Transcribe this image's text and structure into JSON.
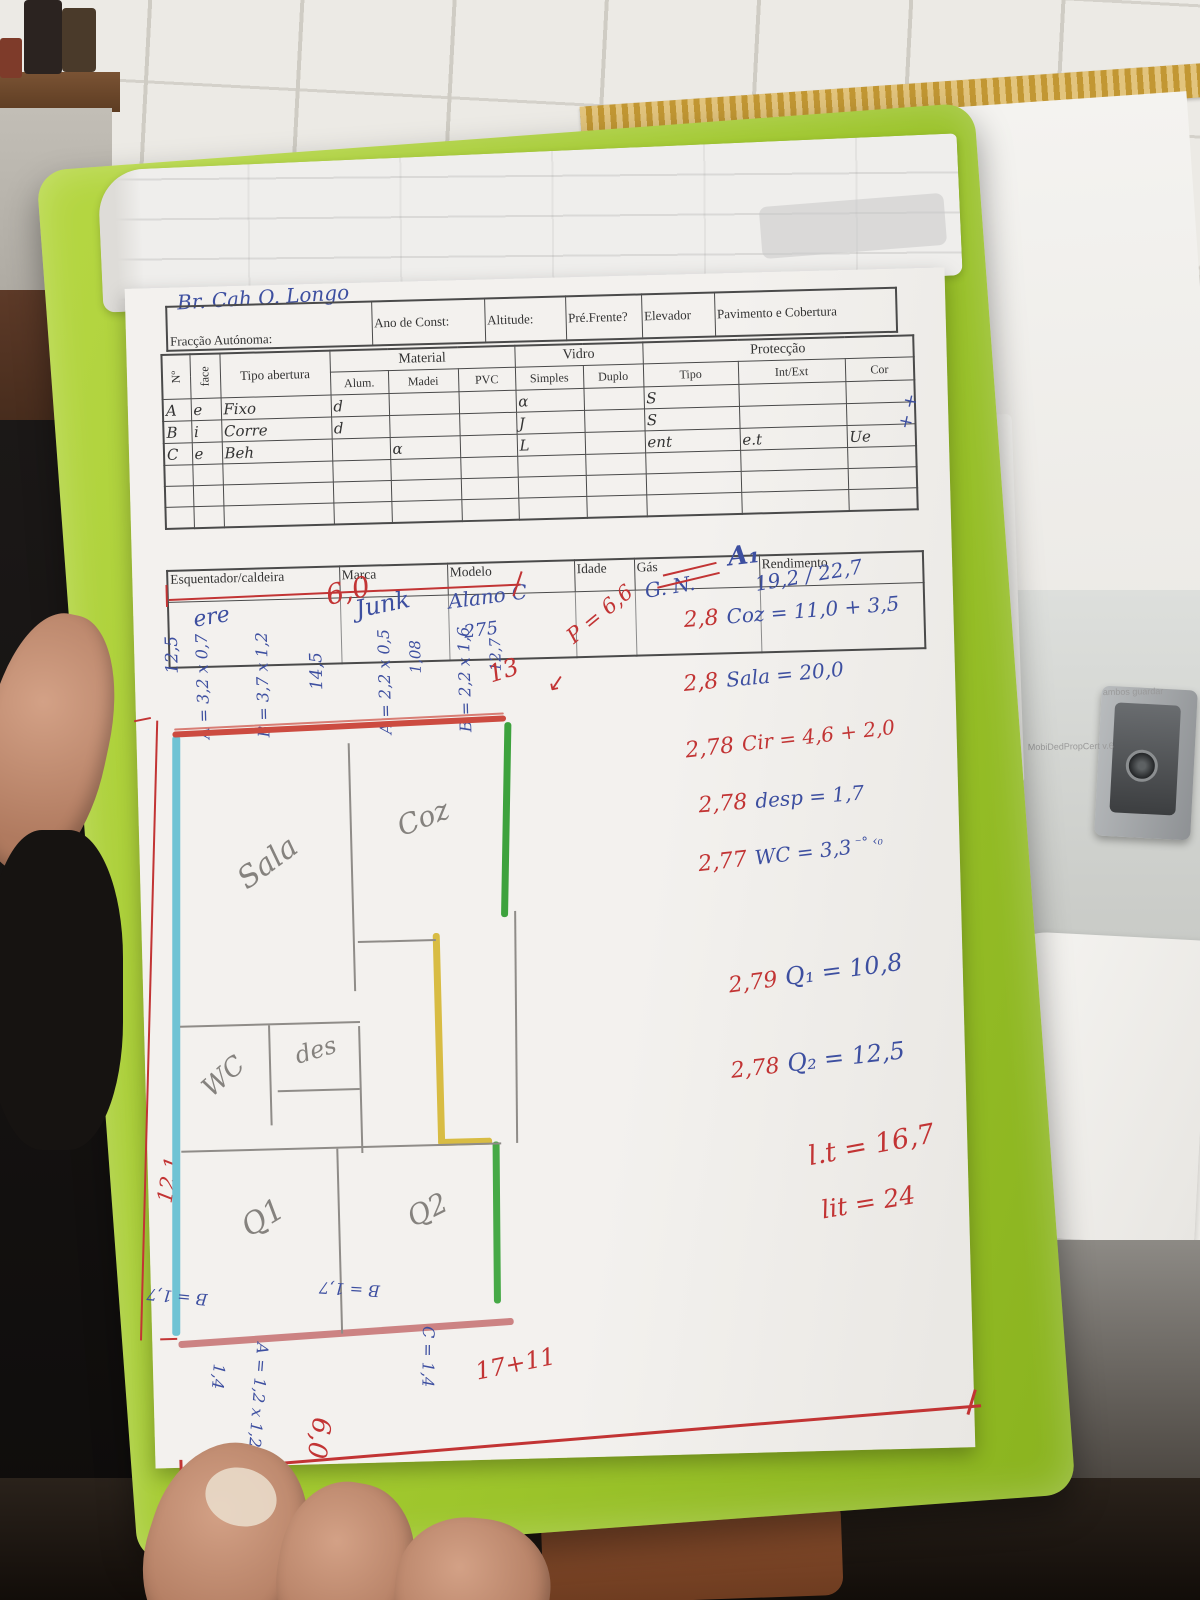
{
  "photo": {
    "background_texts": {
      "paper_note_1": "ambos guardar",
      "paper_note_2": "MobiDedPropCert v.6"
    }
  },
  "form": {
    "title_scribble": "Br. Cah O. Longo",
    "header": {
      "fraccao": "Fracção Autónoma:",
      "ano": "Ano de Const:",
      "altitude": "Altitude:",
      "pre_frente": "Pré.Frente?",
      "elevador": "Elevador",
      "pavimento": "Pavimento e Cobertura"
    },
    "table": {
      "groups": {
        "material": "Material",
        "vidro": "Vidro",
        "proteccao": "Protecção"
      },
      "cols": {
        "no": "Nº",
        "face": "face",
        "tipo_abertura": "Tipo abertura",
        "alum": "Alum.",
        "madei": "Madei",
        "pvc": "PVC",
        "simples": "Simples",
        "duplo": "Duplo",
        "tipo": "Tipo",
        "int_ext": "Int/Ext",
        "cor": "Cor"
      },
      "rows": [
        {
          "no": "A",
          "face": "e",
          "tipo": "Fixo",
          "alum": "d",
          "madei": "",
          "pvc": "",
          "simples": "α",
          "duplo": "",
          "prot": "S",
          "intext": "",
          "cor": ""
        },
        {
          "no": "B",
          "face": "i",
          "tipo": "Corre",
          "alum": "d",
          "madei": "",
          "pvc": "",
          "simples": "J",
          "duplo": "",
          "prot": "S",
          "intext": "",
          "cor": ""
        },
        {
          "no": "C",
          "face": "e",
          "tipo": "Beh",
          "alum": "",
          "madei": "α",
          "pvc": "",
          "simples": "L",
          "duplo": "",
          "prot": "ent",
          "intext": "e.t",
          "cor": "Ue"
        }
      ],
      "margin_marks": "+ +"
    },
    "heater": {
      "label": "Esquentador/caldeira",
      "marca": "Marca",
      "modelo": "Modelo",
      "idade": "Idade",
      "gas": "Gás",
      "rendimento": "Rendimento",
      "values": {
        "esq": "ere",
        "marca": "Junk",
        "modelo": "Alano C",
        "modelo2": "275",
        "gas": "G. N.",
        "rendimento": "19,2 / 22,7"
      }
    }
  },
  "calcs": {
    "a1": "A₁",
    "lines": [
      {
        "h": "2,8",
        "body": "Coz = 11,0 + 3,5"
      },
      {
        "h": "2,8",
        "body": "Sala = 20,0"
      },
      {
        "h": "2,78",
        "body": "Cir = 4,6 + 2,0"
      },
      {
        "h": "2,78",
        "body": "desp = 1,7"
      },
      {
        "h": "2,77",
        "body": "WC = 3,3",
        "marks": "⁻° ‹₀"
      },
      {
        "h": "2,79",
        "body": "Q₁ = 10,8"
      },
      {
        "h": "2,78",
        "body": "Q₂ = 12,5"
      }
    ],
    "totals": [
      "l.t = 16,7",
      "lit = 24"
    ]
  },
  "plan": {
    "rooms": {
      "sala": "Sala",
      "coz": "Coz",
      "wc": "WC",
      "des": "des",
      "q1": "Q1",
      "q2": "Q2"
    },
    "dims_top": [
      {
        "t": "12,5"
      },
      {
        "t": "A = 3,2 x 0,7"
      },
      {
        "t": "B = 3,7 x 1,2"
      },
      {
        "t": "14,5"
      },
      {
        "t": "A = 2,2 x 0,5"
      },
      {
        "t": "1,08"
      },
      {
        "t": "B = 2,2 x 1,6"
      },
      {
        "t": "12,7"
      }
    ],
    "dim_width": "6,0",
    "dim_13": "13",
    "dim_p": "P = 6,6",
    "dim_p_arrow": "↙",
    "dim_left": "12,1",
    "dims_bottom": {
      "b1": "B = 1,7",
      "b2": "B = 1,7",
      "c": "C = 1,4",
      "a": "A = 1,2 x 1,2",
      "w": "1,4",
      "sum": "17+11",
      "six": "6,0"
    }
  }
}
